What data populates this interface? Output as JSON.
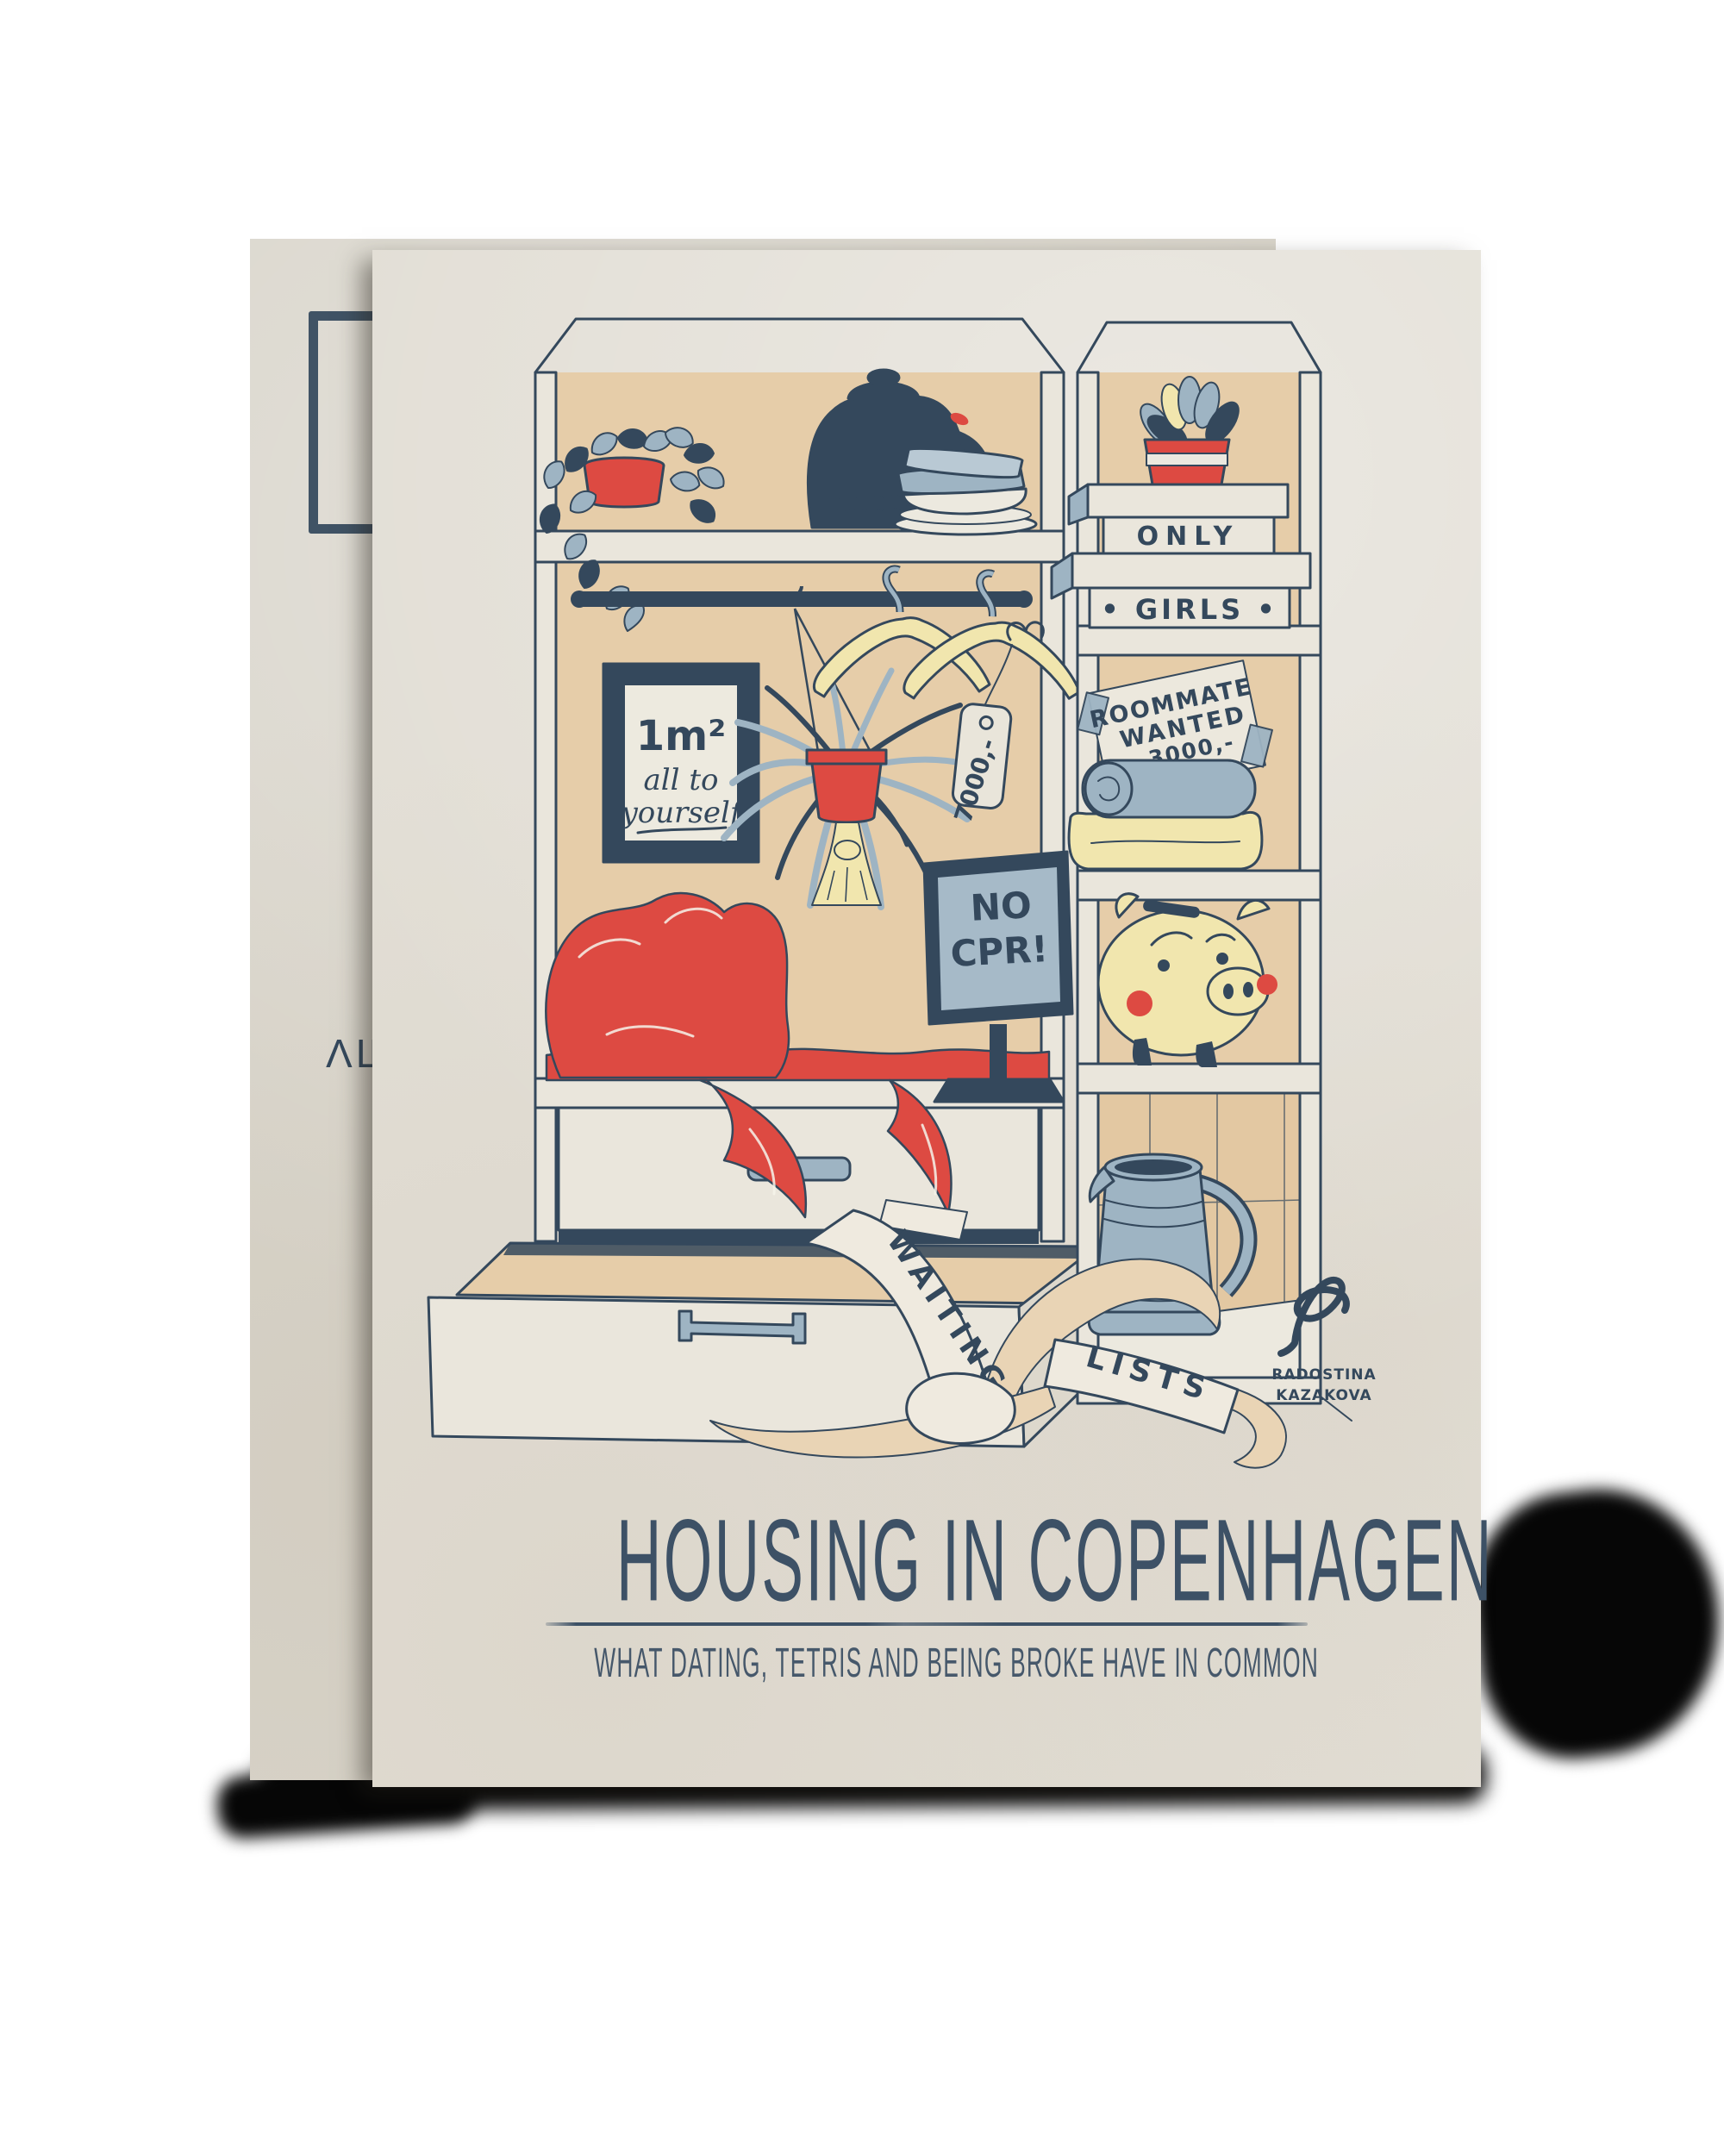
{
  "poster": {
    "title": "HOUSING IN COPENHAGEN",
    "subtitle": "WHAT DATING, TETRIS AND BEING BROKE HAVE IN COMMON",
    "artist": {
      "name_line1": "RADOSTINA",
      "name_line2": "KAZAKOVA"
    },
    "illustration": {
      "frame_sign": {
        "line1": "1m²",
        "line2": "all to",
        "line3": "yourself"
      },
      "price_tag": "7000,-",
      "boxes": {
        "top": "ONLY",
        "bottom": "• GIRLS •"
      },
      "note": {
        "line1": "ROOMMATE",
        "line2": "WANTED",
        "line3": "3000,-"
      },
      "monitor": {
        "line1": "NO",
        "line2": "CPR!"
      },
      "ribbon": {
        "word1": "WAITING",
        "word2": "LISTS"
      },
      "kettle_marks": "00000"
    }
  },
  "back_page": {
    "text_fragment": "ΛШ"
  },
  "colors": {
    "paper": "#e2ded5",
    "paper_back": "#d9d5cb",
    "navy": "#34485c",
    "red": "#dd4a42",
    "slate": "#9eb4c3",
    "slate_dark": "#7e98ac",
    "yellow": "#f1e6ae",
    "tan": "#e6cda9",
    "tan_tiles": "#e3c8a2",
    "cream": "#eae6dc",
    "ribbon": "#efeadf",
    "ribbon_tan": "#e9d4b5",
    "title": "#3d5166",
    "screen": "#a6bac8",
    "white_paper": "#ece9df"
  }
}
